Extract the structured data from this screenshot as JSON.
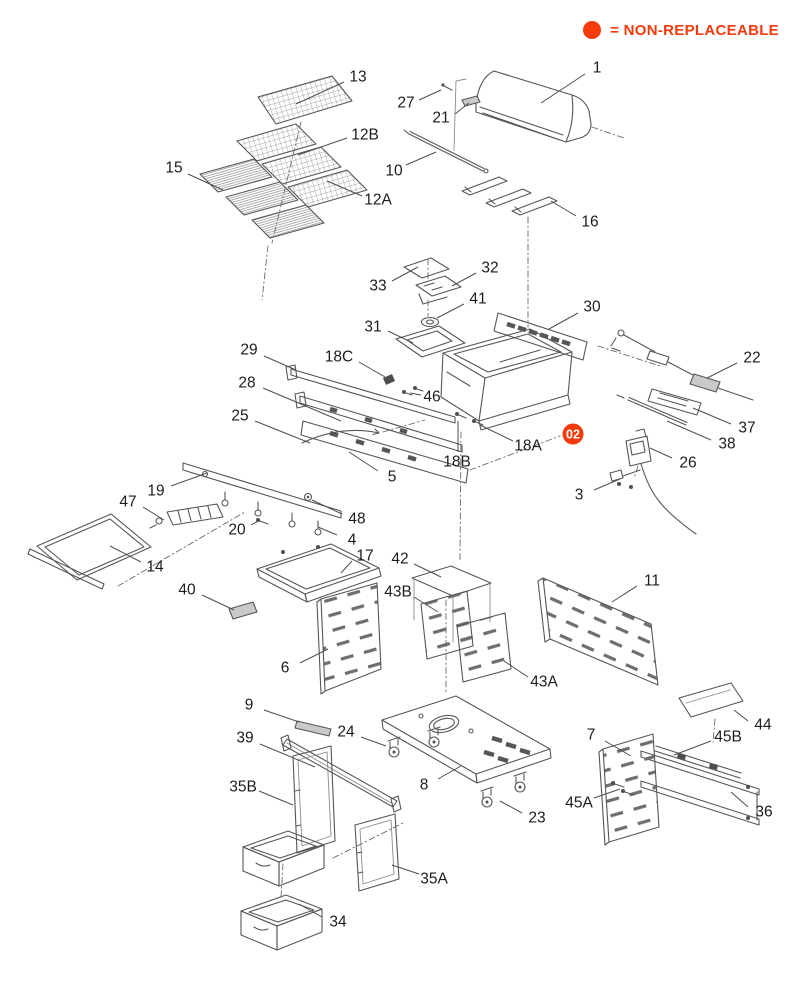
{
  "legend": {
    "icon": "non-replaceable-dot",
    "text": "= NON-REPLACEABLE",
    "color": "#f53a0c"
  },
  "marker": {
    "label": "02",
    "x": 573,
    "y": 434,
    "radius": 10.5,
    "fill": "#f23a0b",
    "text_color": "#ffffff"
  },
  "callouts": [
    {
      "label": "13",
      "x": 358,
      "y": 77,
      "line": [
        344,
        82,
        296,
        104
      ]
    },
    {
      "label": "1",
      "x": 597,
      "y": 68,
      "line": [
        585,
        74,
        541,
        103
      ]
    },
    {
      "label": "27",
      "x": 406,
      "y": 103,
      "line": [
        419,
        100,
        441,
        90
      ]
    },
    {
      "label": "21",
      "x": 441,
      "y": 118,
      "line": [
        455,
        114,
        469,
        103
      ]
    },
    {
      "label": "12B",
      "x": 365,
      "y": 135,
      "line": [
        347,
        138,
        298,
        155
      ]
    },
    {
      "label": "10",
      "x": 394,
      "y": 171,
      "line": [
        406,
        165,
        436,
        152
      ]
    },
    {
      "label": "15",
      "x": 174,
      "y": 168,
      "line": [
        188,
        174,
        223,
        190
      ]
    },
    {
      "label": "12A",
      "x": 378,
      "y": 200,
      "line": [
        362,
        196,
        327,
        181
      ]
    },
    {
      "label": "16",
      "x": 590,
      "y": 222,
      "line": [
        576,
        216,
        551,
        201
      ]
    },
    {
      "label": "32",
      "x": 490,
      "y": 268,
      "line": [
        476,
        273,
        452,
        286
      ]
    },
    {
      "label": "33",
      "x": 378,
      "y": 286,
      "line": [
        392,
        281,
        418,
        267
      ]
    },
    {
      "label": "41",
      "x": 478,
      "y": 299,
      "line": [
        464,
        304,
        437,
        318
      ]
    },
    {
      "label": "30",
      "x": 592,
      "y": 307,
      "line": [
        578,
        313,
        549,
        329
      ]
    },
    {
      "label": "31",
      "x": 373,
      "y": 327,
      "line": [
        388,
        331,
        413,
        343
      ]
    },
    {
      "label": "29",
      "x": 249,
      "y": 350,
      "line": [
        264,
        356,
        296,
        370
      ]
    },
    {
      "label": "18C",
      "x": 339,
      "y": 357,
      "line": [
        359,
        362,
        385,
        377
      ]
    },
    {
      "label": "22",
      "x": 752,
      "y": 358,
      "line": [
        737,
        363,
        707,
        378
      ]
    },
    {
      "label": "28",
      "x": 247,
      "y": 383,
      "line": [
        263,
        388,
        341,
        421
      ]
    },
    {
      "label": "46",
      "x": 432,
      "y": 397,
      "line": [
        421,
        395,
        410,
        393
      ]
    },
    {
      "label": "25",
      "x": 240,
      "y": 416,
      "line": [
        255,
        421,
        310,
        443
      ]
    },
    {
      "label": "37",
      "x": 747,
      "y": 428,
      "line": [
        731,
        424,
        693,
        408
      ]
    },
    {
      "label": "38",
      "x": 727,
      "y": 444,
      "line": [
        711,
        440,
        667,
        421
      ]
    },
    {
      "label": "18A",
      "x": 528,
      "y": 446,
      "line": [
        513,
        441,
        480,
        425
      ]
    },
    {
      "label": "26",
      "x": 688,
      "y": 463,
      "line": [
        672,
        458,
        650,
        448
      ]
    },
    {
      "label": "18B",
      "x": 457,
      "y": 462,
      "line": [
        458,
        452,
        458,
        421
      ]
    },
    {
      "label": "19",
      "x": 156,
      "y": 491,
      "line": [
        171,
        486,
        207,
        473
      ]
    },
    {
      "label": "5",
      "x": 392,
      "y": 477,
      "line": [
        378,
        471,
        349,
        452
      ]
    },
    {
      "label": "3",
      "x": 579,
      "y": 495,
      "line": [
        594,
        490,
        620,
        479
      ]
    },
    {
      "label": "47",
      "x": 128,
      "y": 502,
      "line": [
        143,
        507,
        164,
        520
      ]
    },
    {
      "label": "48",
      "x": 357,
      "y": 519,
      "line": [
        342,
        514,
        312,
        500
      ]
    },
    {
      "label": "20",
      "x": 237,
      "y": 530,
      "line": [
        251,
        525,
        260,
        520
      ]
    },
    {
      "label": "4",
      "x": 352,
      "y": 540,
      "line": [
        337,
        535,
        318,
        527
      ]
    },
    {
      "label": "14",
      "x": 155,
      "y": 567,
      "line": [
        141,
        562,
        110,
        546
      ]
    },
    {
      "label": "17",
      "x": 365,
      "y": 556,
      "line": [
        352,
        561,
        341,
        573
      ]
    },
    {
      "label": "42",
      "x": 400,
      "y": 559,
      "line": [
        414,
        564,
        441,
        577
      ]
    },
    {
      "label": "40",
      "x": 187,
      "y": 590,
      "line": [
        202,
        595,
        234,
        610
      ]
    },
    {
      "label": "43B",
      "x": 398,
      "y": 592,
      "line": [
        414,
        597,
        438,
        612
      ]
    },
    {
      "label": "11",
      "x": 652,
      "y": 581,
      "line": [
        637,
        586,
        612,
        602
      ]
    },
    {
      "label": "6",
      "x": 285,
      "y": 668,
      "line": [
        300,
        663,
        328,
        649
      ]
    },
    {
      "label": "43A",
      "x": 544,
      "y": 682,
      "line": [
        528,
        677,
        504,
        661
      ]
    },
    {
      "label": "9",
      "x": 249,
      "y": 705,
      "line": [
        264,
        710,
        299,
        722
      ]
    },
    {
      "label": "44",
      "x": 763,
      "y": 725,
      "line": [
        748,
        721,
        734,
        710
      ]
    },
    {
      "label": "45B",
      "x": 728,
      "y": 737,
      "line": [
        711,
        741,
        674,
        755
      ]
    },
    {
      "label": "24",
      "x": 346,
      "y": 732,
      "line": [
        361,
        737,
        386,
        746
      ]
    },
    {
      "label": "39",
      "x": 245,
      "y": 738,
      "line": [
        260,
        744,
        315,
        767
      ]
    },
    {
      "label": "7",
      "x": 591,
      "y": 735,
      "line": [
        605,
        741,
        631,
        756
      ]
    },
    {
      "label": "8",
      "x": 424,
      "y": 785,
      "line": [
        438,
        779,
        461,
        766
      ]
    },
    {
      "label": "35B",
      "x": 243,
      "y": 787,
      "line": [
        259,
        791,
        293,
        805
      ]
    },
    {
      "label": "45A",
      "x": 579,
      "y": 803,
      "line": [
        594,
        798,
        620,
        789
      ]
    },
    {
      "label": "36",
      "x": 764,
      "y": 812,
      "line": [
        748,
        807,
        731,
        792
      ]
    },
    {
      "label": "23",
      "x": 537,
      "y": 818,
      "line": [
        522,
        813,
        500,
        801
      ]
    },
    {
      "label": "35A",
      "x": 434,
      "y": 879,
      "line": [
        419,
        874,
        392,
        865
      ]
    },
    {
      "label": "34",
      "x": 338,
      "y": 922,
      "line": [
        322,
        917,
        299,
        904
      ]
    }
  ]
}
